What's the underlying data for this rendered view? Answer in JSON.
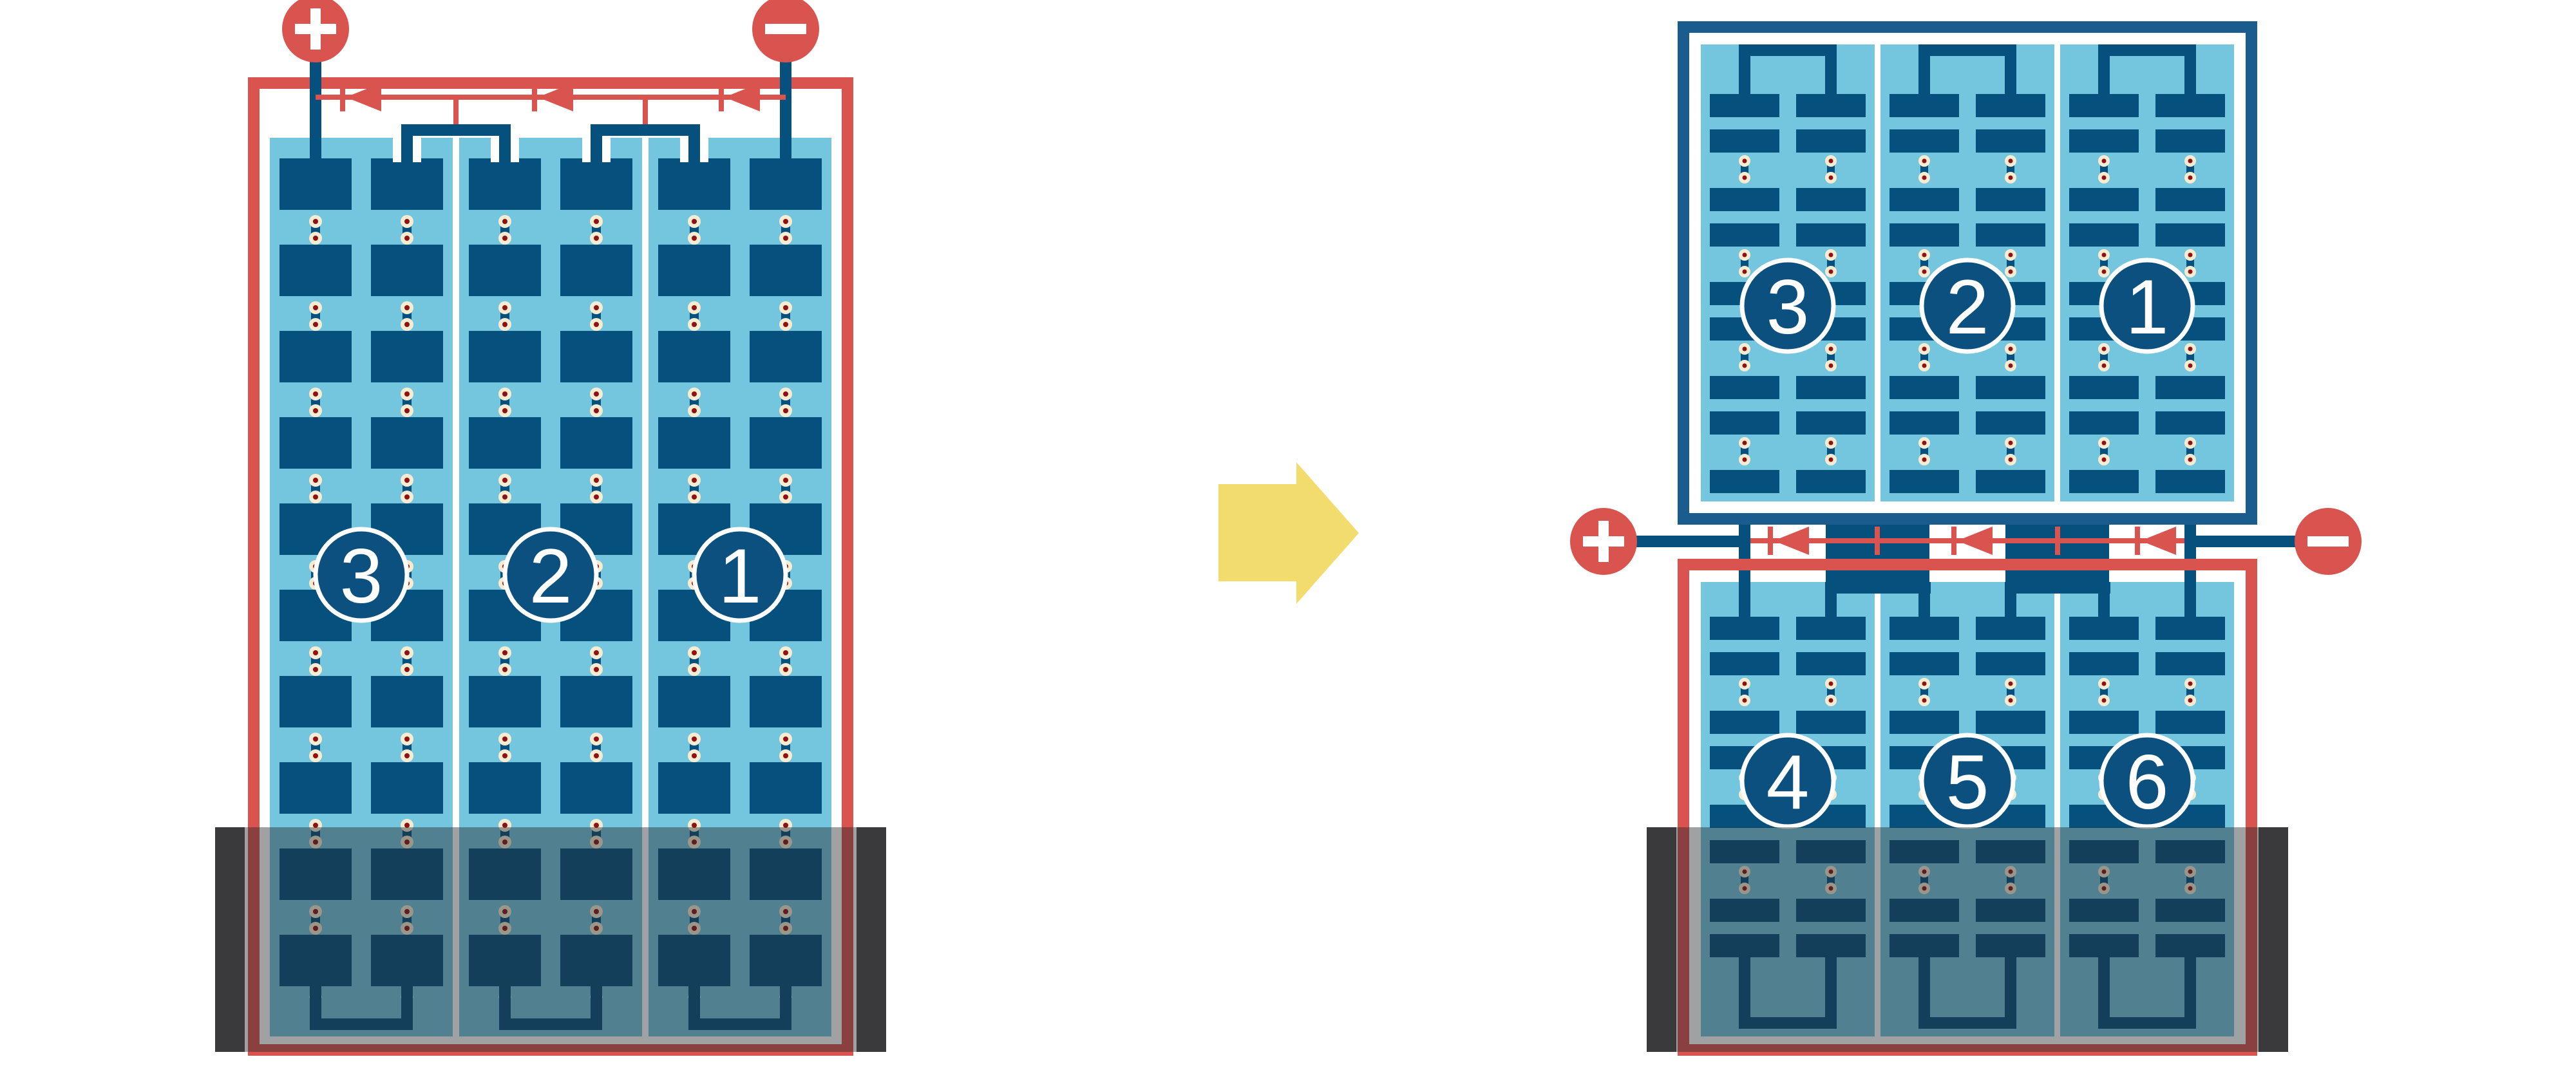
{
  "figure": {
    "left_diagram": {
      "positive_terminal_symbol": "+",
      "negative_terminal_symbol": "−",
      "sections": [
        {
          "label": "3"
        },
        {
          "label": "2"
        },
        {
          "label": "1"
        }
      ]
    },
    "transition_arrow": {
      "direction": "right"
    },
    "right_diagram": {
      "positive_terminal_symbol": "+",
      "negative_terminal_symbol": "−",
      "top_panel_sections": [
        {
          "label": "3"
        },
        {
          "label": "2"
        },
        {
          "label": "1"
        }
      ],
      "bottom_panel_sections": [
        {
          "label": "4"
        },
        {
          "label": "5"
        },
        {
          "label": "6"
        }
      ]
    },
    "colors": {
      "cell_navy": "#05507D",
      "panel_light_blue": "#73C6DE",
      "frame_blue": "#1A5C8E",
      "wire_red": "#D9534F",
      "solder_dot_cream": "#F7ECD2",
      "solder_dot_center": "#8E1212",
      "shade_bar_dark": "#3A3A3C",
      "arrow_yellow": "#F2DC6D"
    }
  }
}
